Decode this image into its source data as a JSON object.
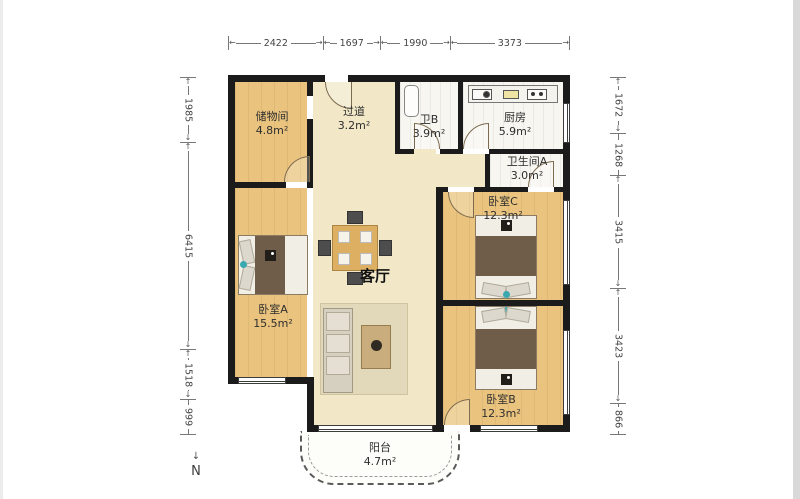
{
  "plan_title": "apartment-floor-plan",
  "dims": {
    "top": [
      "2422",
      "1697",
      "1990",
      "3373"
    ],
    "left": [
      "1985",
      "6415",
      "1518",
      "999"
    ],
    "right": [
      "1672",
      "1268",
      "3415",
      "3423",
      "866"
    ]
  },
  "rooms": {
    "storage": {
      "name": "储物间",
      "area": "4.8m²"
    },
    "hallway": {
      "name": "过道",
      "area": "3.2m²"
    },
    "bath_b": {
      "name": "卫B",
      "area": "3.9m²"
    },
    "kitchen": {
      "name": "厨房",
      "area": "5.9m²"
    },
    "bath_a": {
      "name": "卫生间A",
      "area": "3.0m²"
    },
    "bedroom_c": {
      "name": "卧室C",
      "area": "12.3m²"
    },
    "living": {
      "name": "客厅"
    },
    "bedroom_a": {
      "name": "卧室A",
      "area": "15.5m²"
    },
    "bedroom_b": {
      "name": "卧室B",
      "area": "12.3m²"
    },
    "balcony": {
      "name": "阳台",
      "area": "4.7m²"
    }
  },
  "icons": {
    "arrow_left": "←",
    "arrow_right": "→",
    "arrow_up": "↑",
    "arrow_down": "↓",
    "north_needle": "↓"
  },
  "compass": {
    "label": "N"
  },
  "colors": {
    "wall": "#1b1b1b",
    "wood_floor": "#eac47f",
    "beige_floor": "#f2e8c8",
    "white_room": "#f7f6f1",
    "accent_teal": "#3aa8b0",
    "blanket_brown": "#6f5d4a"
  }
}
